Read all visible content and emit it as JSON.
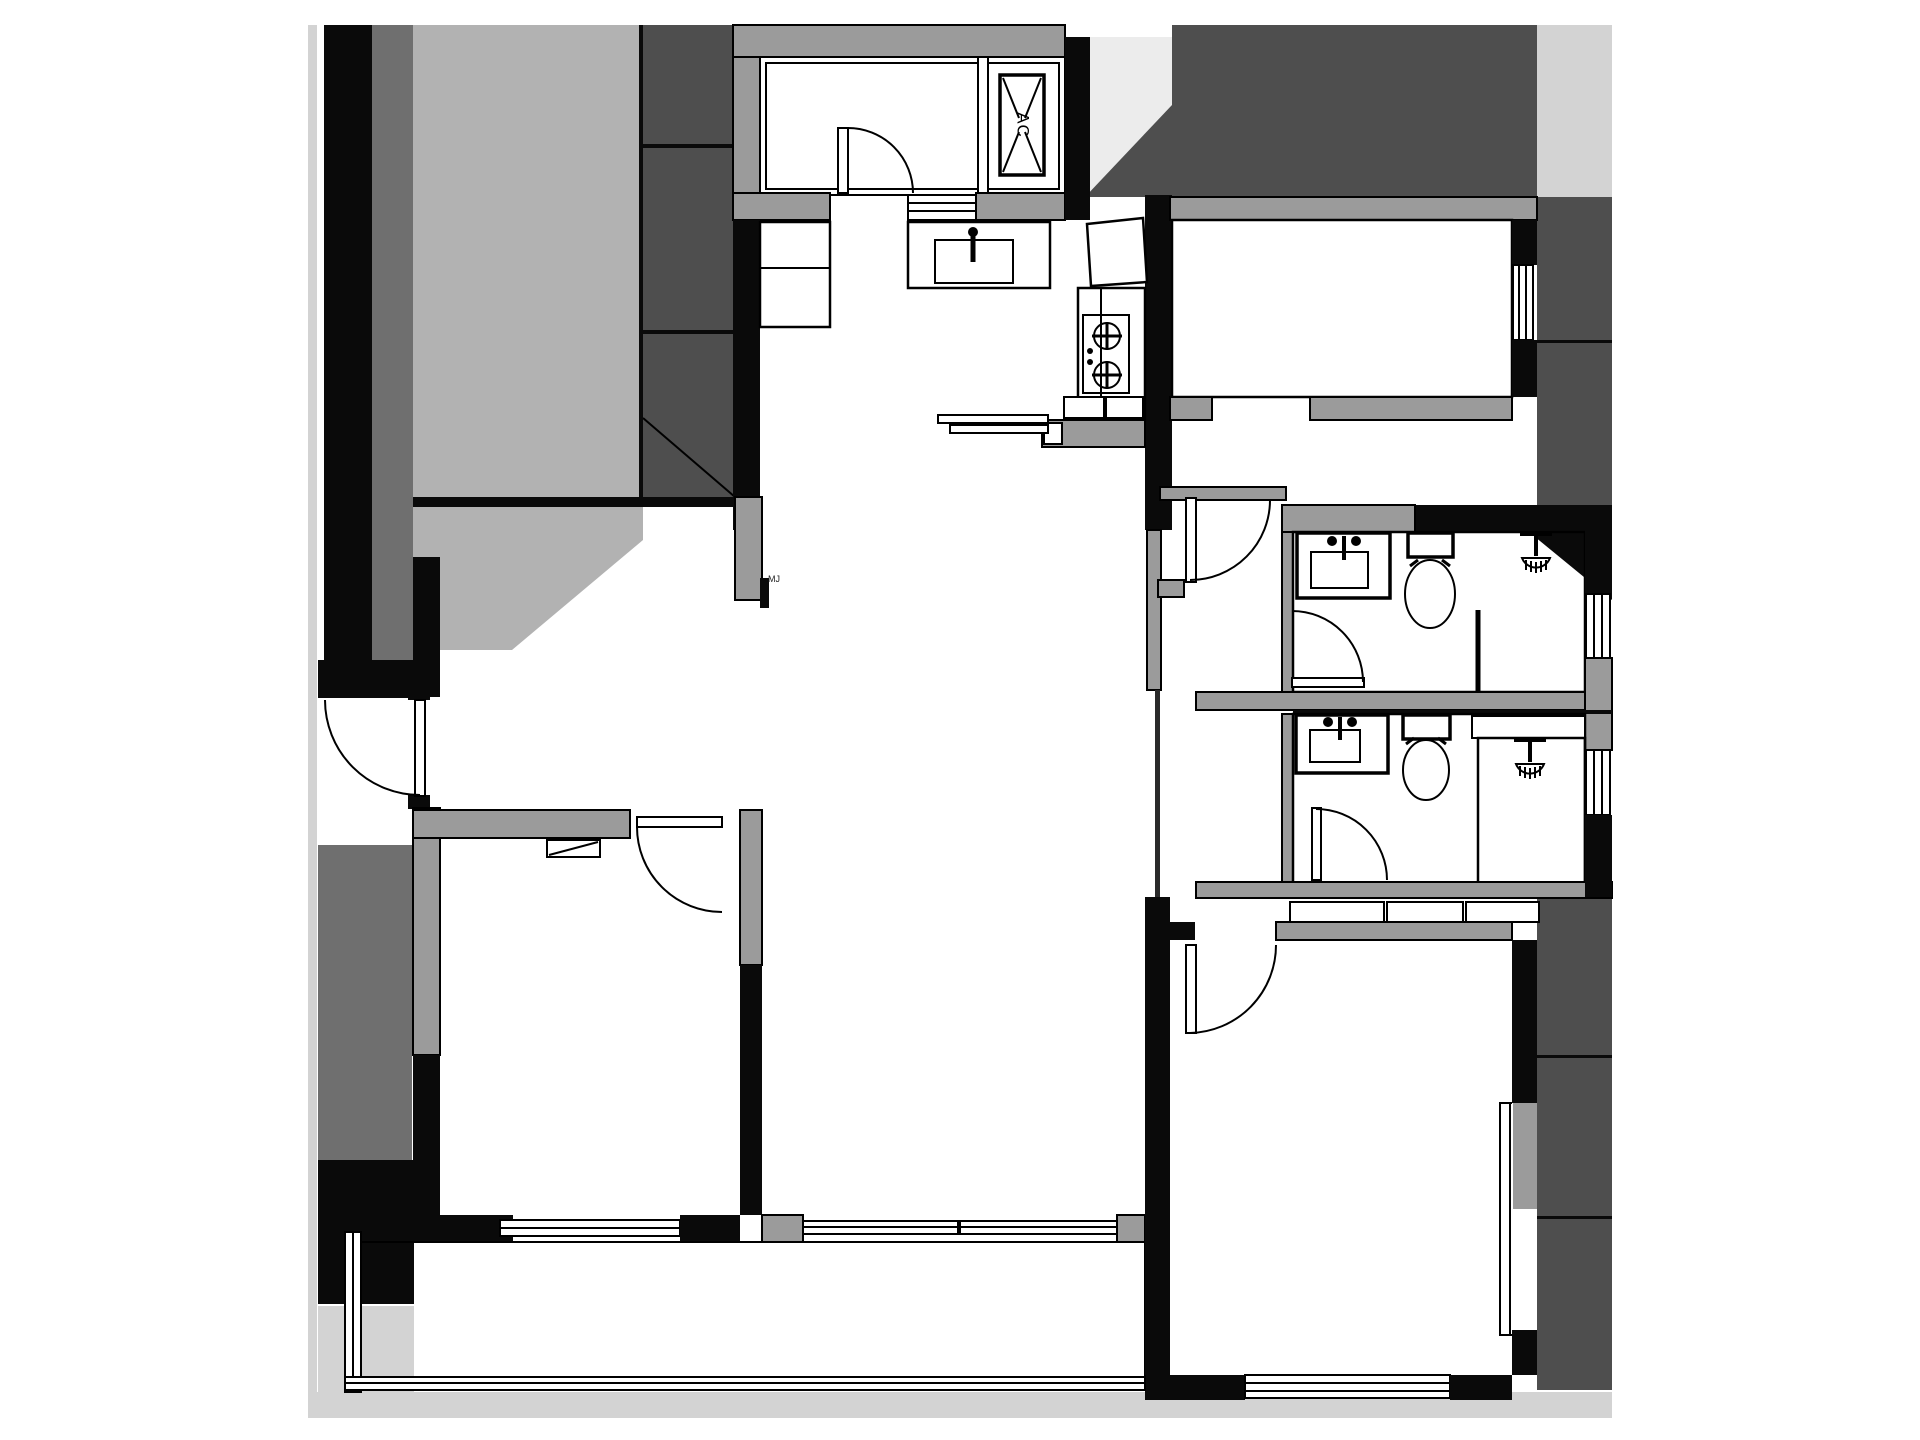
{
  "labels": {
    "ac_unit": "AC",
    "shaft_note": "MJ"
  },
  "palette": {
    "wall_structural": "#0a0a0a",
    "wall_partition": "#9b9b9b",
    "shade_dark": "#4e4e4e",
    "shade_mid": "#6f6f6f",
    "shade_light": "#b2b2b2",
    "shade_lighter": "#d3d3d3",
    "shade_faint": "#ececec",
    "floor": "#ffffff"
  },
  "icons": [
    "ac-unit-icon",
    "kitchen-sink-icon",
    "stove-icon",
    "vanity-sink-icon",
    "toilet-icon",
    "shower-head-icon",
    "door-swing-icon",
    "sliding-window-icon",
    "wardrobe-icon"
  ]
}
